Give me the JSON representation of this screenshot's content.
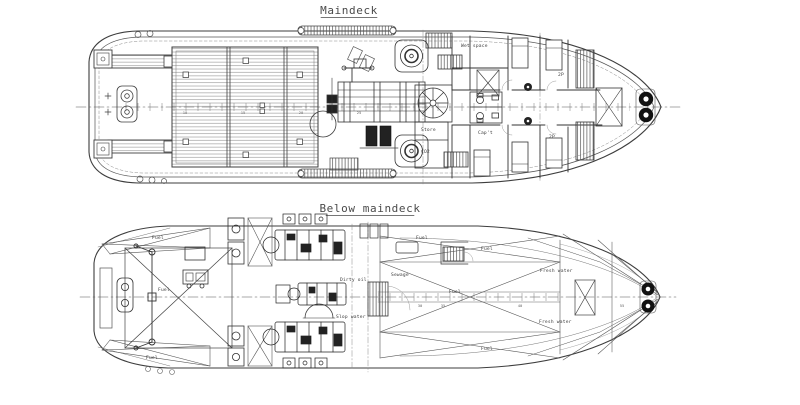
{
  "drawing": {
    "colors": {
      "ink": "#3d3d3d",
      "paper": "#ffffff",
      "hatch": "#8a8a8a"
    },
    "titles": {
      "maindeck": "Maindeck",
      "below_maindeck": "Below  maindeck"
    },
    "maindeck": {
      "rooms": {
        "wet_space": "Wet space",
        "captain": "Cap't",
        "cabin_upper_2p": "2P",
        "cabin_lower_2p": "2P",
        "store": "Store",
        "co2": "CO2"
      },
      "frame_numbers": {
        "f1": "10",
        "f2": "15",
        "f3": "20",
        "f4": "25"
      }
    },
    "below_maindeck": {
      "tanks": {
        "fuel_aft_port": "Fuel",
        "fuel_aft_stbd": "Fuel",
        "fuel_hold": "Fuel",
        "fuel_mid_port": "Fuel",
        "fuel_mid_fwd": "Fuel",
        "fuel_center": "Fuel",
        "fuel_mid_stbd": "Fuel",
        "fresh_water_port": "Fresh water",
        "fresh_water_stbd": "Fresh water",
        "dirty_oil": "Dirty oil",
        "slop_water": "Slop water",
        "sewage": "Sewage"
      },
      "frame_numbers": {
        "f1": "30",
        "f2": "35",
        "f3": "40",
        "f4": "55"
      }
    }
  }
}
